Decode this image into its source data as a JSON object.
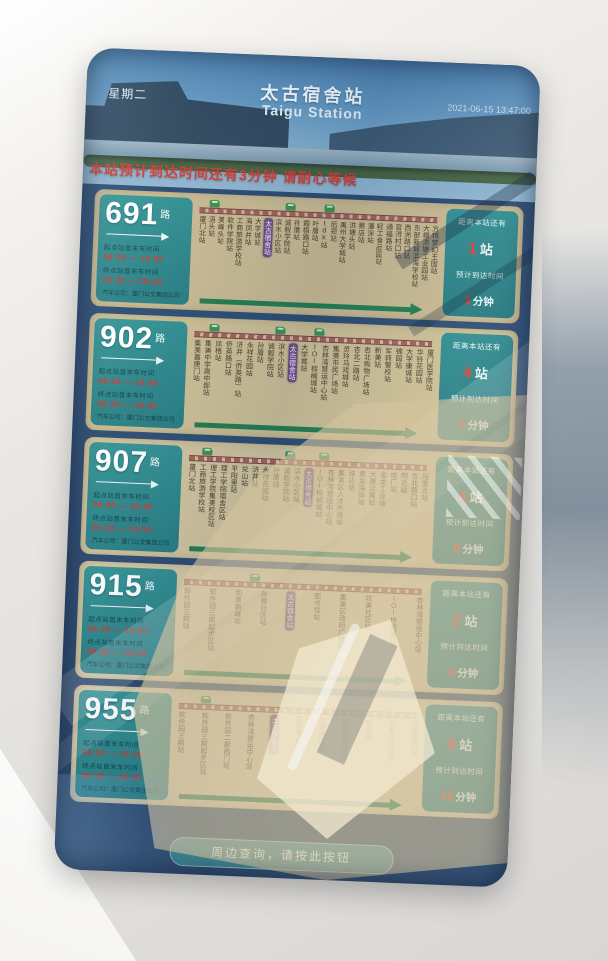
{
  "header": {
    "weekday": "星期二",
    "station_zh": "太古宿舍站",
    "station_en": "Taigu Station",
    "datetime": "2021-06-15 13:47:00",
    "marquee": "本站预计到达时间还有3分钟 请耐心等候"
  },
  "labels": {
    "route_suffix": "路",
    "first_label": "起点站首末车时间",
    "last_label": "终点站首末车时间",
    "eta_prefix": "距离本站还有",
    "eta_station_unit": "站",
    "eta_time_label": "预计到达时间",
    "eta_minute_unit": "分钟"
  },
  "footer": {
    "button_label": "周边查询，请按此按钮"
  },
  "colors": {
    "panel_teal": "#2d8d90",
    "panel_beige": "#cfc199",
    "track_maroon": "#7c393c",
    "current_station_purple": "#6d4a80",
    "direction_green": "#1f7a4b",
    "alert_red": "#d5332b"
  },
  "routes": [
    {
      "number": "691",
      "start_times": "06:30 — 19:30",
      "end_times": "06:30 — 19:30",
      "company": "汽车公司：厦门公交集团公司",
      "eta_stations": "1",
      "eta_minutes": "3",
      "current_index": 7,
      "bus_positions": [
        5,
        36,
        52
      ],
      "stations": [
        "厦门北站",
        "浯头站",
        "美峰头站",
        "软件学院站",
        "工商旅游学校站",
        "海凤井站",
        "大学城站",
        "太古宿舍站",
        "滨水小区站",
        "诚毅学院站",
        "孙厝站",
        "霞梧路口站",
        "叶厝站",
        "tdk站",
        "后郑站",
        "禹州大学城站",
        "洪塘头站",
        "蔡店站",
        "潘涂站",
        "轻工食品园站",
        "通福路站",
        "官浔村口站",
        "西洲路口站",
        "东部新城滨海学校站",
        "大嶝洪塘工业园站",
        "方特梦幻王国站"
      ]
    },
    {
      "number": "902",
      "start_times": "06:30 — 19:30",
      "end_times": "06:30 — 19:30",
      "company": "汽车公司：厦门公交集团公司",
      "eta_stations": "4",
      "eta_minutes": "9",
      "current_index": 9,
      "bus_positions": [
        7,
        34,
        50
      ],
      "stations": [
        "集美嘉庚门站",
        "集美中学高中部站",
        "凤梧站",
        "侨英路口站",
        "浒井（侨英路）站",
        "永祥花园站",
        "孙厝站",
        "诚毅学院站",
        "滨水小区站",
        "太古宿舍站",
        "大学城站",
        "IOI棕榈城站",
        "杏林湾营运中心站",
        "集美市民广场站",
        "灵玲马戏城站",
        "杏北二路站",
        "杏北购物广场站",
        "新美站",
        "军转警校站",
        "锦园站",
        "大学康城站",
        "华铃花园站",
        "厦门医学院站"
      ]
    },
    {
      "number": "907",
      "start_times": "06:30 — 19:30",
      "end_times": "06:30 — 19:30",
      "company": "汽车公司：厦门公交集团公司",
      "eta_stations": "4",
      "eta_minutes": "8",
      "current_index": 11,
      "bus_positions": [
        6,
        40,
        54
      ],
      "stations": [
        "厦门北站",
        "工商旅游学校站",
        "理工学院集美校区站",
        "理工学院宿舍区站",
        "平阳里站",
        "兑山站",
        "浒井站",
        "永祥花园站",
        "孙厝站",
        "诚毅学院站",
        "滨水小区站",
        "太古宿舍站",
        "IOI棕榈城站",
        "杏林湾营运中心站",
        "集美区人才市场站",
        "路达站",
        "黄金海岸站",
        "大唐公寓站",
        "金龙工业站",
        "电厂站",
        "明达站",
        "杏北路口站",
        "马銮北站"
      ]
    },
    {
      "number": "915",
      "start_times": "06:30 — 19:30",
      "end_times": "06:30 — 19:30",
      "company": "汽车公司：厦门公交集团公司",
      "eta_stations": "2",
      "eta_minutes": "6",
      "current_index": 4,
      "bus_positions": [
        28
      ],
      "stations": [
        "软件园三期站",
        "软件园三期起步区站",
        "和美新城站",
        "孙厝社区站",
        "太古宿舍站",
        "图书馆站",
        "集美区政府广场站",
        "坑美社区站",
        "IOI棕榈城站",
        "杏林湾营运中心站"
      ]
    },
    {
      "number": "955",
      "start_times": "06:30 — 19:30",
      "end_times": "06:30 — 19:30",
      "company": "汽车公司：厦门公交集团公司",
      "eta_stations": "5",
      "eta_minutes": "15",
      "current_index": 4,
      "bus_positions": [
        10
      ],
      "stations": [
        "软件园三期站",
        "软件园三期起步区站",
        "软件园二期西门站",
        "杏林湾营运中心站",
        "太古宿舍站",
        "观音寺站",
        "沙堤路口站",
        "美峰保障房站",
        "中澳站",
        "七星公交场站",
        "石亭路口站"
      ]
    }
  ]
}
